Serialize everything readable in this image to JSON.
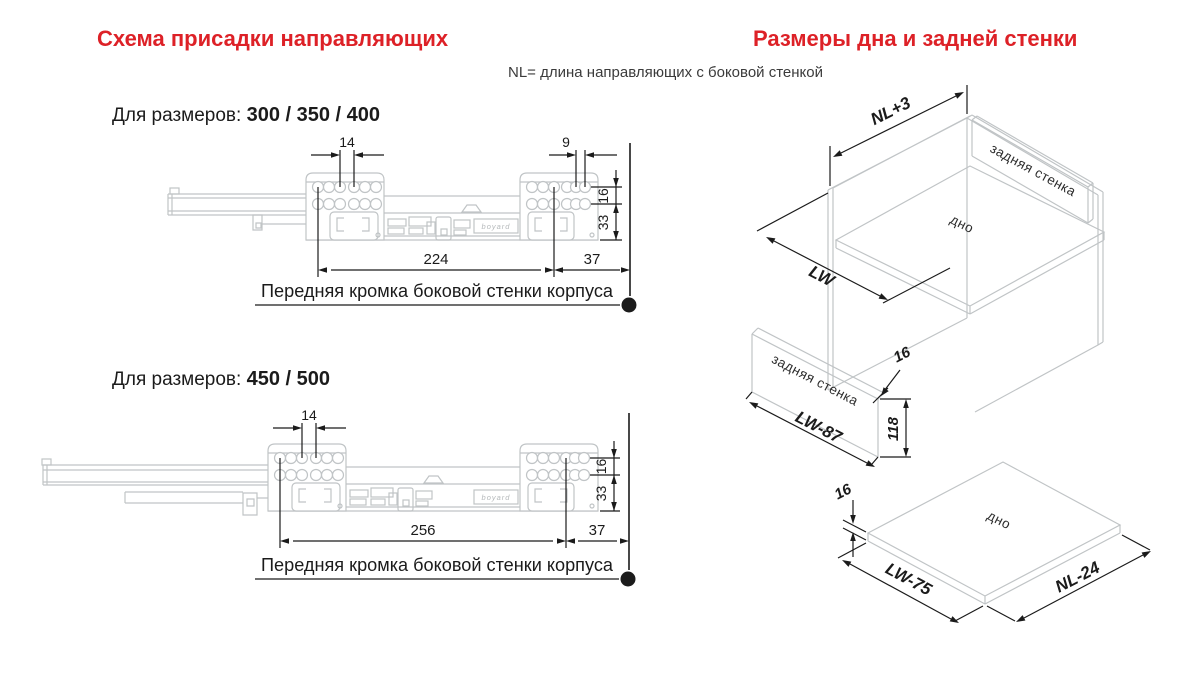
{
  "header": {
    "left_title": "Схема присадки направляющих",
    "right_title": "Размеры дна и задней стенки",
    "subtitle": "NL= длина направляющих с боковой стенкой"
  },
  "drawing1": {
    "label_prefix": "Для размеров:",
    "label_sizes": "300 / 350 / 400",
    "dim_hole_pitch_left": "14",
    "dim_hole_pitch_right": "9",
    "dim_row_gap": "16",
    "dim_bottom_offset": "33",
    "dim_front_span": "224",
    "dim_rear_span": "37",
    "edge_label": "Передняя кромка боковой стенки корпуса",
    "brand": "boyard"
  },
  "drawing2": {
    "label_prefix": "Для размеров:",
    "label_sizes": "450 / 500",
    "dim_hole_pitch_left": "14",
    "dim_row_gap": "16",
    "dim_bottom_offset": "33",
    "dim_front_span": "256",
    "dim_rear_span": "37",
    "edge_label": "Передняя кромка боковой стенки корпуса",
    "brand": "boyard"
  },
  "iso": {
    "cabinet": {
      "dim_depth": "NL+3",
      "dim_width": "LW",
      "back_wall_label": "задняя стенка",
      "bottom_label": "дно"
    },
    "back_panel": {
      "label": "задняя стенка",
      "dim_length": "LW-87",
      "dim_height": "118",
      "dim_thickness": "16"
    },
    "bottom_panel": {
      "label": "дно",
      "dim_width": "LW-75",
      "dim_depth": "NL-24",
      "dim_thickness": "16"
    }
  },
  "colors": {
    "accent_red": "#dd2127",
    "line_dark": "#1b1b1b",
    "line_gray": "#c0c4c6"
  }
}
